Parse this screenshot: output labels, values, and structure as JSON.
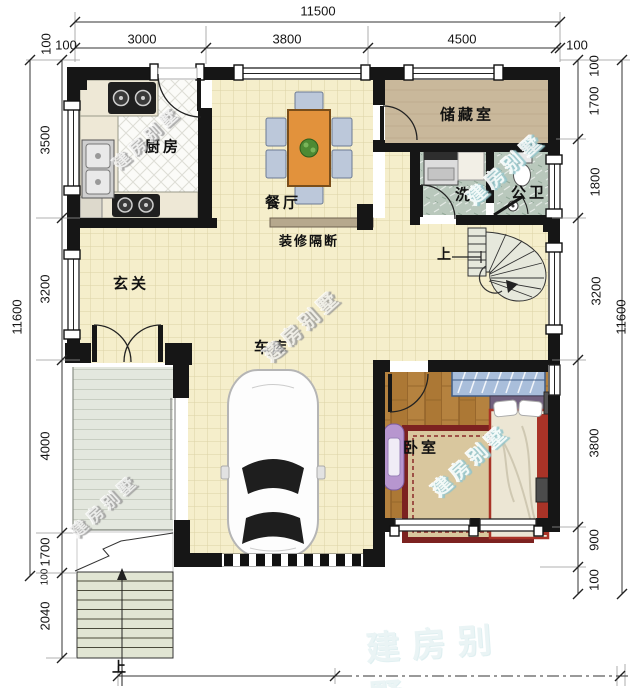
{
  "dims": {
    "top": {
      "overall": "11500",
      "segs": [
        "100",
        "3000",
        "3800",
        "4500",
        "100"
      ]
    },
    "left": {
      "overall": "11600",
      "segs": [
        "100",
        "3500",
        "3200",
        "4000",
        "1700",
        "100",
        "2040"
      ]
    },
    "right": {
      "overall": "11600",
      "segs": [
        "100",
        "1700",
        "1800",
        "3200",
        "3800",
        "900",
        "100"
      ]
    }
  },
  "labels": {
    "kitchen": "厨房",
    "dining": "餐厅",
    "storage": "储藏室",
    "laundry": "洗",
    "bathroom": "公卫",
    "foyer": "玄关",
    "garage": "车库",
    "bedroom": "卧室",
    "partition": "装修隔断",
    "up": "上"
  },
  "watermark": {
    "text": "建房别墅"
  },
  "colors": {
    "wall": "#161616",
    "tile_floor": "#f5eecb",
    "wood_floor": "#b5823f",
    "storage_floor": "#c9b89b",
    "bath_floor": "#b9c8bc",
    "table": "#e2923c",
    "watermark_teal": "#8fc3c9",
    "bed_frame_red": "#a93327",
    "rug_border": "#7c2220"
  }
}
